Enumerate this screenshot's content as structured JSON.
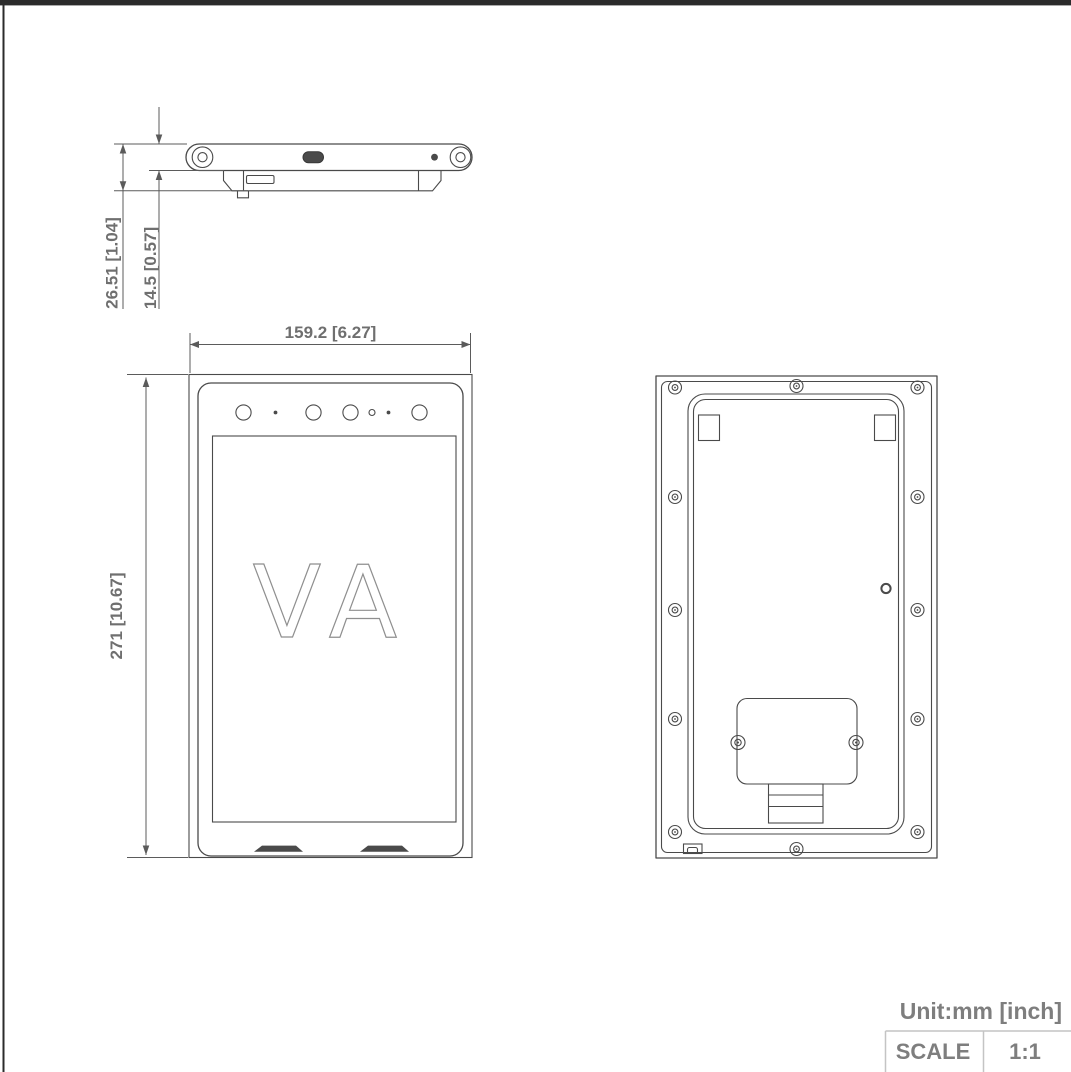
{
  "dimensions": {
    "top_total": "26.51 [1.04]",
    "top_body": "14.5 [0.57]",
    "front_width": "159.2 [6.27]",
    "front_height": "271 [10.67]"
  },
  "logo": {
    "text": "VA"
  },
  "footer": {
    "unit": "Unit:mm [inch]",
    "scale_label": "SCALE",
    "scale_value": "1:1"
  },
  "colors": {
    "line": "#4a4a4a",
    "dim_text": "#6f6f6f",
    "logo_stroke": "#8f8f8f",
    "footer_text": "#7e7e7e",
    "table_border": "#c4c4c4"
  }
}
